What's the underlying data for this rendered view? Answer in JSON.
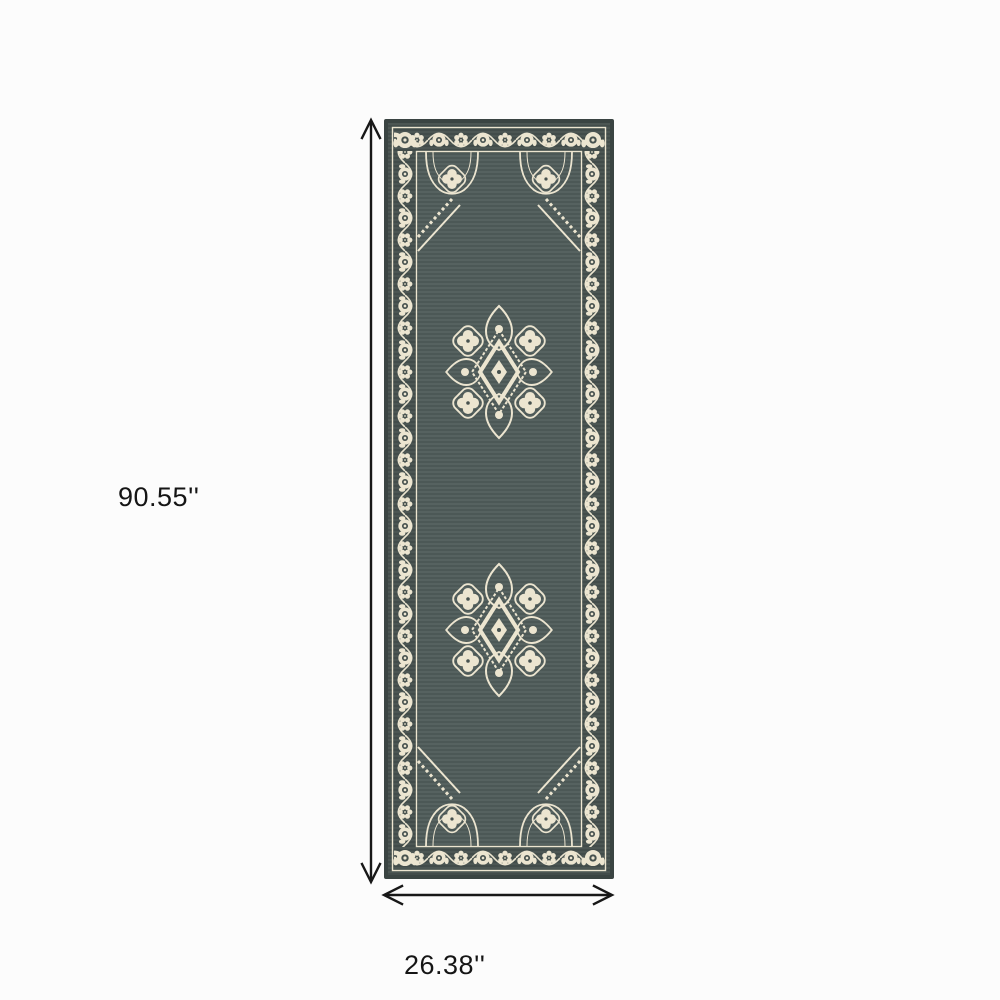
{
  "page": {
    "background": "#fcfcfc"
  },
  "annotations": {
    "height_label": "90.55''",
    "width_label": "26.38''",
    "arrow_color": "#181818",
    "label_color": "#151515"
  },
  "rug": {
    "description": "Gray runner rug with ivory floral vine border, corner roses and two diamond floral medallions",
    "medallion_count": 2,
    "colors": {
      "field": "#515d5b",
      "border_background": "#46514e",
      "edge": "#3a4442",
      "ivory": "#ece5d0"
    }
  }
}
